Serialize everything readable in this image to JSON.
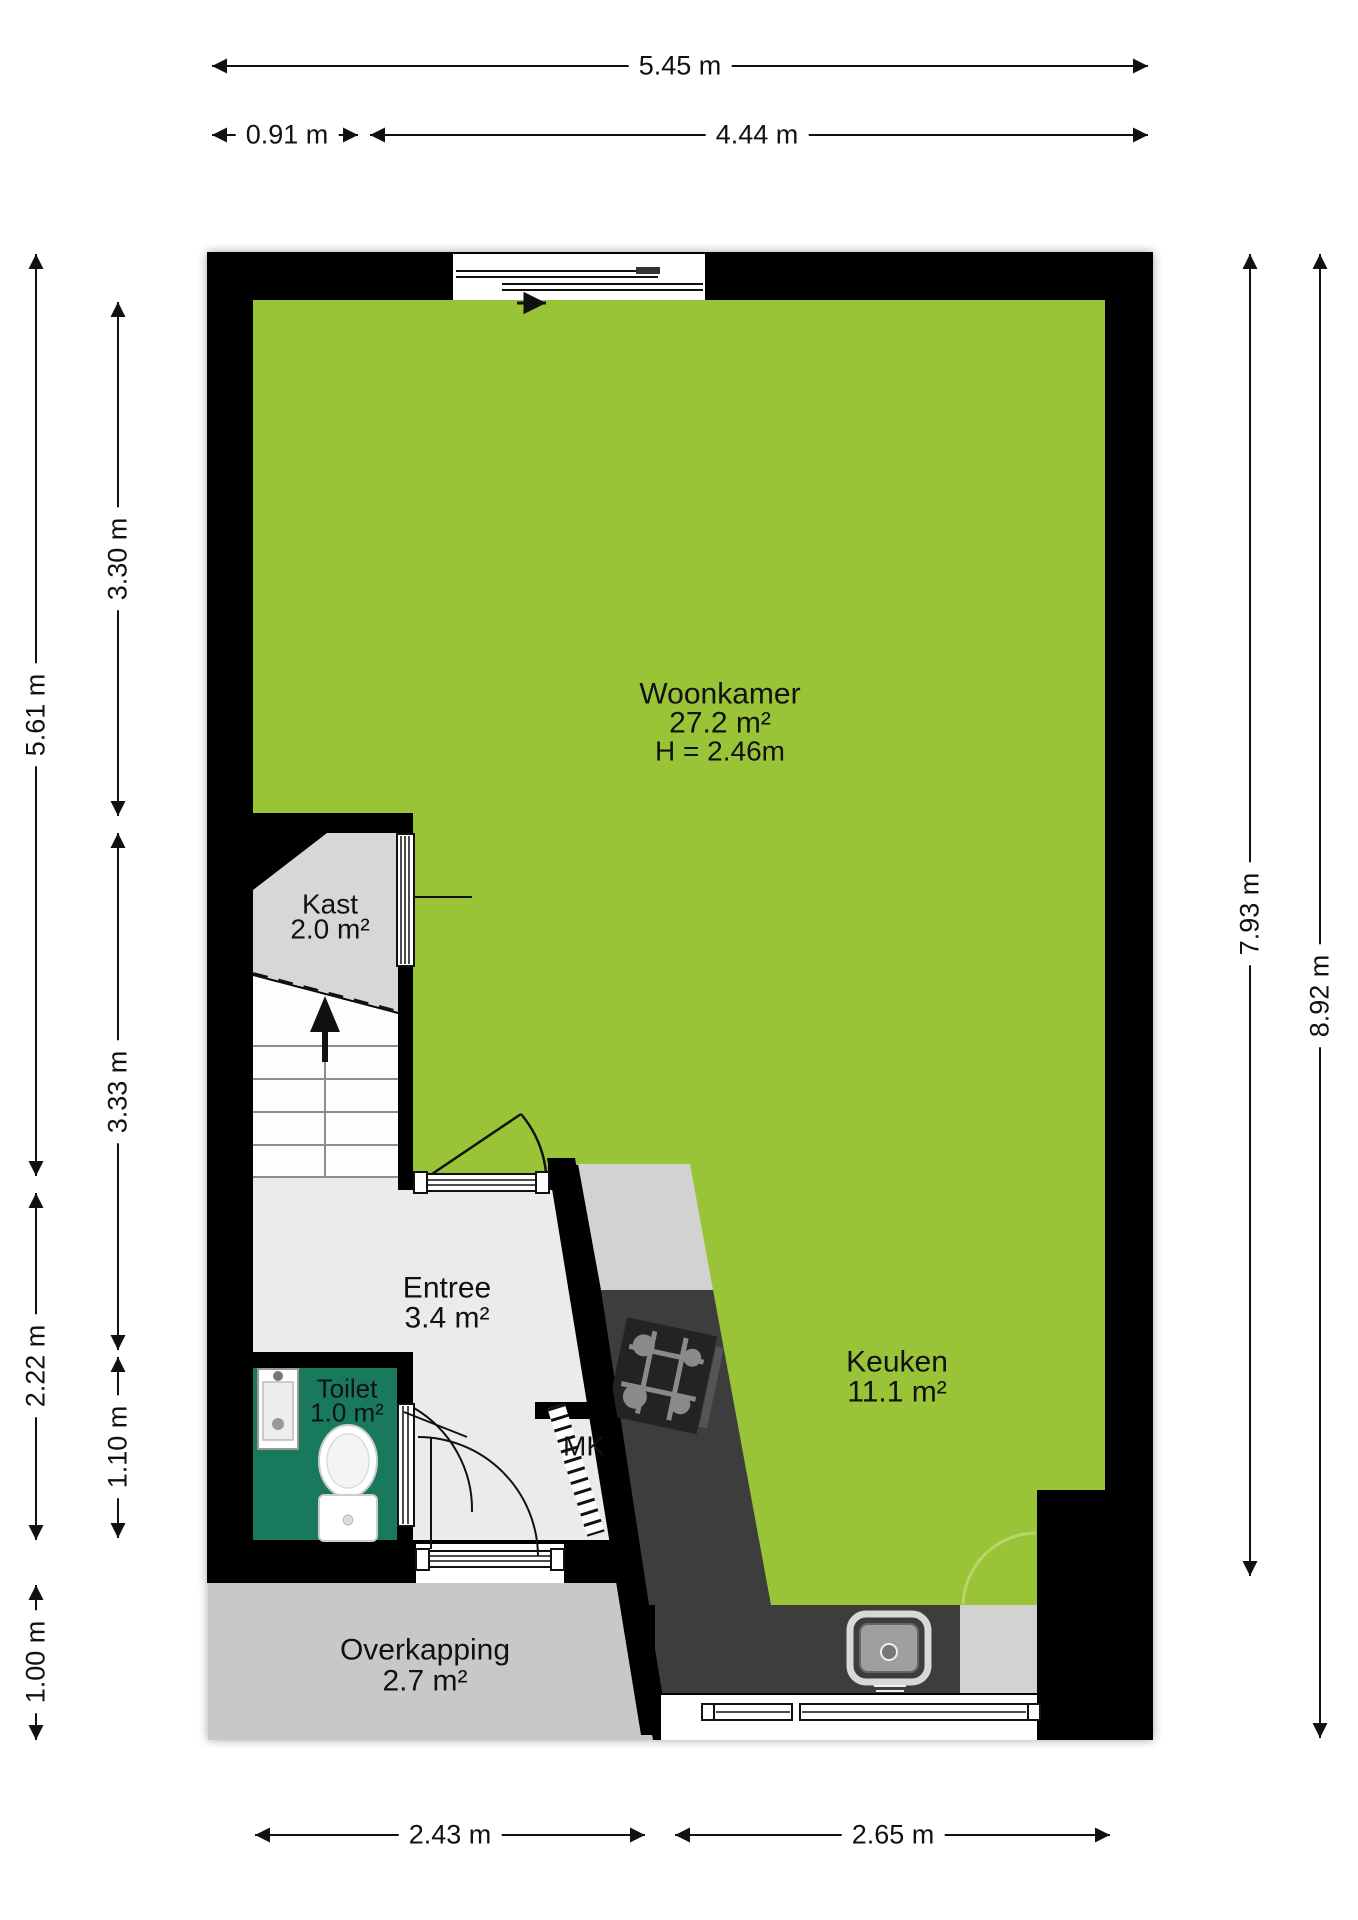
{
  "plan": {
    "rooms": {
      "woonkamer": {
        "name": "Woonkamer",
        "area": "27.2 m²",
        "ceiling_height": "H = 2.46m"
      },
      "kast": {
        "name": "Kast",
        "area": "2.0 m²"
      },
      "entree": {
        "name": "Entree",
        "area": "3.4 m²"
      },
      "toilet": {
        "name": "Toilet",
        "area": "1.0 m²"
      },
      "meterkast": {
        "name": "MK"
      },
      "keuken": {
        "name": "Keuken",
        "area": "11.1 m²"
      },
      "overkapping": {
        "name": "Overkapping",
        "area": "2.7 m²"
      }
    },
    "dimensions": {
      "top_total": "5.45 m",
      "top_left_segment": "0.91 m",
      "top_right_segment": "4.44 m",
      "left_outer_upper": "5.61 m",
      "left_outer_middle": "2.22 m",
      "left_outer_lower": "1.00 m",
      "left_inner_upper": "3.30 m",
      "left_inner_middle": "3.33 m",
      "left_inner_lower": "1.10 m",
      "right_inner": "7.93 m",
      "right_outer": "8.92 m",
      "bottom_left_segment": "2.43 m",
      "bottom_right_segment": "2.65 m"
    },
    "colors": {
      "wall": "#000000",
      "living_fill": "#9ac437",
      "toilet_fill": "#18795d",
      "closet_fill": "#d7d7d7",
      "entree_fill": "#ebebeb",
      "canopy_fill": "#c8c8c8",
      "counter_dark": "#3d3d3d",
      "counter_light": "#d2d2d2"
    }
  }
}
